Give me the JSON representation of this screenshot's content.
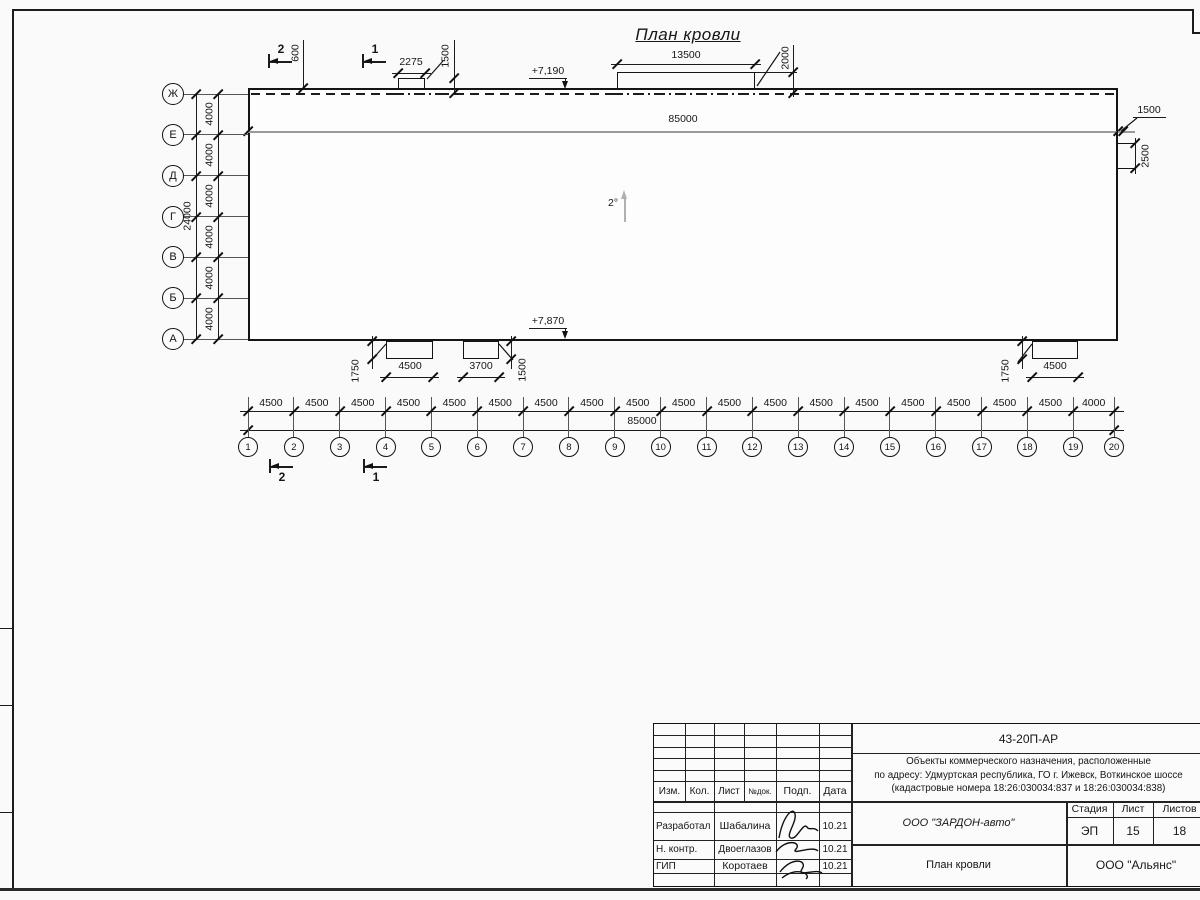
{
  "drawing": {
    "title": "План кровли",
    "slope_label": "2°",
    "elevation_top": "+7,190",
    "elevation_bottom": "+7,870",
    "top_total_label": "85000",
    "top_offset_label": "600",
    "top_box_small": {
      "width_label": "2275",
      "offset_label": "1500"
    },
    "top_box_large": {
      "width_label": "13500",
      "offset_label": "2000"
    },
    "right_box": {
      "width_label": "1500",
      "height_label": "2500"
    },
    "bottom_box_a": {
      "width_label": "4500",
      "offset_label": "1750"
    },
    "bottom_box_b": {
      "width_label": "3700",
      "offset_label": "1500"
    },
    "bottom_box_c": {
      "width_label": "4500",
      "offset_label": "1750"
    },
    "section_markers": {
      "top": [
        "2",
        "1"
      ],
      "bottom": [
        "2",
        "1"
      ]
    },
    "grid": {
      "rows": [
        "Ж",
        "Е",
        "Д",
        "Г",
        "В",
        "Б",
        "А"
      ],
      "row_spacing_labels": [
        "4000",
        "4000",
        "4000",
        "4000",
        "4000",
        "4000"
      ],
      "row_total_label": "24000",
      "cols": [
        "1",
        "2",
        "3",
        "4",
        "5",
        "6",
        "7",
        "8",
        "9",
        "10",
        "11",
        "12",
        "13",
        "14",
        "15",
        "16",
        "17",
        "18",
        "19",
        "20"
      ],
      "col_spacing_labels": [
        "4500",
        "4500",
        "4500",
        "4500",
        "4500",
        "4500",
        "4500",
        "4500",
        "4500",
        "4500",
        "4500",
        "4500",
        "4500",
        "4500",
        "4500",
        "4500",
        "4500",
        "4500",
        "4000"
      ],
      "col_total_label": "85000"
    }
  },
  "title_block": {
    "doc_number": "43-20П-АР",
    "project_line1": "Объекты коммерческого назначения, расположенные",
    "project_line2": "по адресу: Удмуртская республика, ГО г. Ижевск, Воткинское шоссе",
    "project_line3": "(кадастровые номера 18:26:030034:837 и 18:26:030034:838)",
    "header_cols": [
      "Изм.",
      "Кол.",
      "Лист",
      "№док.",
      "Подп.",
      "Дата"
    ],
    "stage_header": [
      "Стадия",
      "Лист",
      "Листов"
    ],
    "stage_values": [
      "ЭП",
      "15",
      "18"
    ],
    "client": "ООО \"ЗАРДОН-авто\"",
    "sheet_title": "План кровли",
    "company": "ООО \"Альянс\"",
    "people": [
      {
        "role": "Разработал",
        "name": "Шабалина",
        "date": "10.21"
      },
      {
        "role": "Н. контр.",
        "name": "Двоеглазов",
        "date": "10.21"
      },
      {
        "role": "ГИП",
        "name": "Коротаев",
        "date": "10.21"
      }
    ]
  },
  "colors": {
    "line": "#1c1c1c",
    "gray": "#9a9a9a",
    "background": "#fafafa"
  }
}
